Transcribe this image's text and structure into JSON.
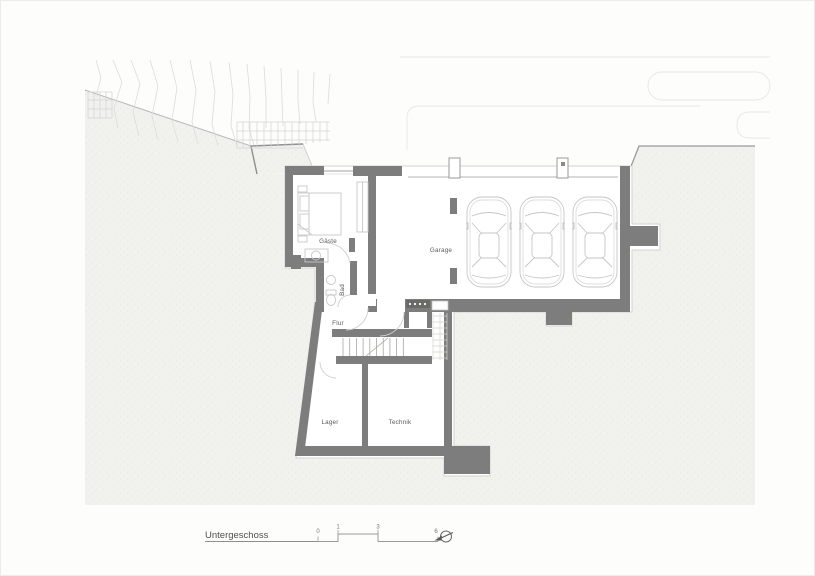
{
  "page": {
    "title": "Untergeschoss"
  },
  "plan": {
    "type": "basement-floor-plan",
    "rooms": {
      "gaeste": "Gäste",
      "garage": "Garage",
      "bad": "Bad",
      "flur": "Flur",
      "lager": "Lager",
      "technik": "Technik"
    },
    "cars_in_garage": 3,
    "features": [
      "staircase",
      "bed",
      "wardrobe",
      "toilet",
      "washbasin",
      "garage-columns",
      "terrain-contours"
    ]
  },
  "scalebar": {
    "ticks": [
      "0",
      "1",
      "3",
      "6"
    ]
  },
  "icons": {
    "north": "north-arrow-icon"
  },
  "colors": {
    "wall": "#7d7d7d",
    "ground_texture": "#f1f1ee",
    "paper": "#fdfdfc",
    "fixture_line": "#c8c8c8",
    "label_text": "#5a5a5a"
  }
}
